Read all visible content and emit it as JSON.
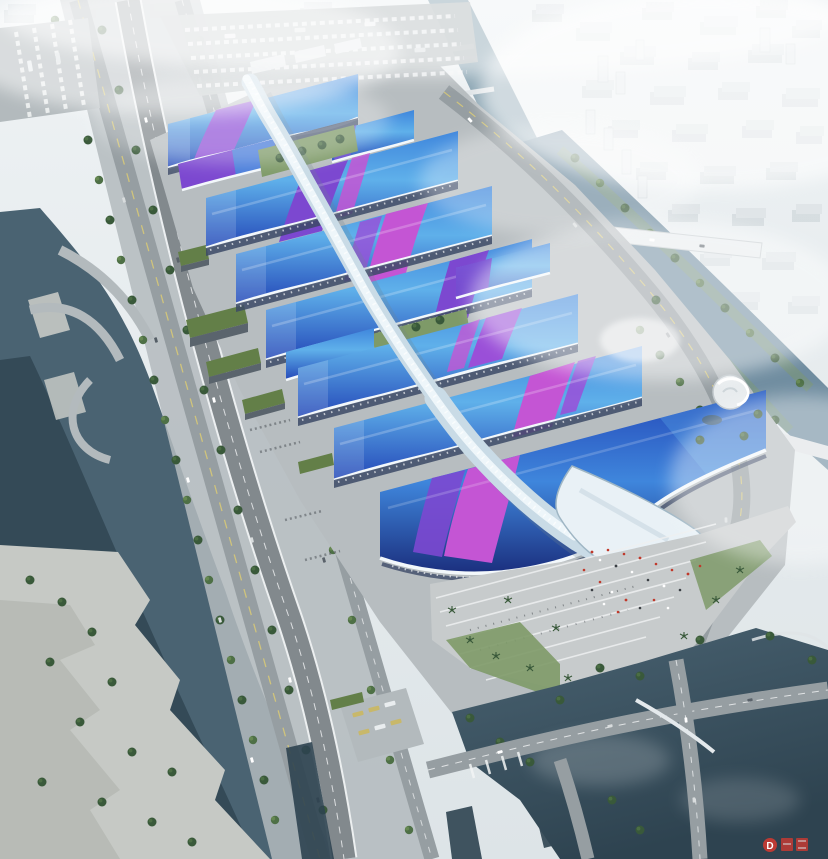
{
  "scene": {
    "type": "aerial-architectural-rendering",
    "subject": "Riverside exhibition and convention center complex: rows of blue wave-form hall roofs with purple ribbon accents, a sinuous white central concourse spine ending in a south entrance canopy, surrounded by roads, canals, parks and a hazy city skyline",
    "watermark": {
      "symbol": "D"
    }
  },
  "palette": {
    "sky_top": "#eef2f4",
    "sky_bottom": "#dde4e7",
    "city_block": "#dfe5e8",
    "city_shadow": "#c3ccd0",
    "fog": "#ffffff",
    "water_canal": "#8aa4b2",
    "water_river": "#708da0",
    "water_deep": "#2e4350",
    "water_mid": "#4a6372",
    "road": "#969ea2",
    "road_light": "#b3babd",
    "road_dark": "#82898d",
    "lane": "#d6c878",
    "mark": "#f2f4f5",
    "apron": "#b7bdc0",
    "plaza": "#c7cbcc",
    "lawn": "#7e9a68",
    "tree": "#4e7046",
    "tree_dark": "#39593a",
    "tree_light": "#6d8f55",
    "roof_light": "#5fb0ea",
    "roof_mid": "#3f86dc",
    "roof_deep": "#2448b8",
    "roof_navy": "#1b2f7e",
    "ribbon_purple": "#7c48d0",
    "ribbon_violet": "#9a4fd8",
    "ribbon_magenta": "#c455d4",
    "trim": "#f3f8fb",
    "fascia": "#3c4a66",
    "spine_base": "#c9dbe6",
    "spine_hi": "#eef6fa",
    "spine_shadow": "#6f8291",
    "canopy": "#e9f1f6",
    "canopy_edge": "#9fb6c4",
    "warehouse_roof": "#637f48",
    "warehouse_side": "#5a646d",
    "concrete": "#c6c9c5",
    "bus_yellow": "#c8b86a",
    "crowd_red": "#c0392b",
    "crowd_dark": "#3a3f44",
    "watermark_red": "#cc3a31"
  }
}
